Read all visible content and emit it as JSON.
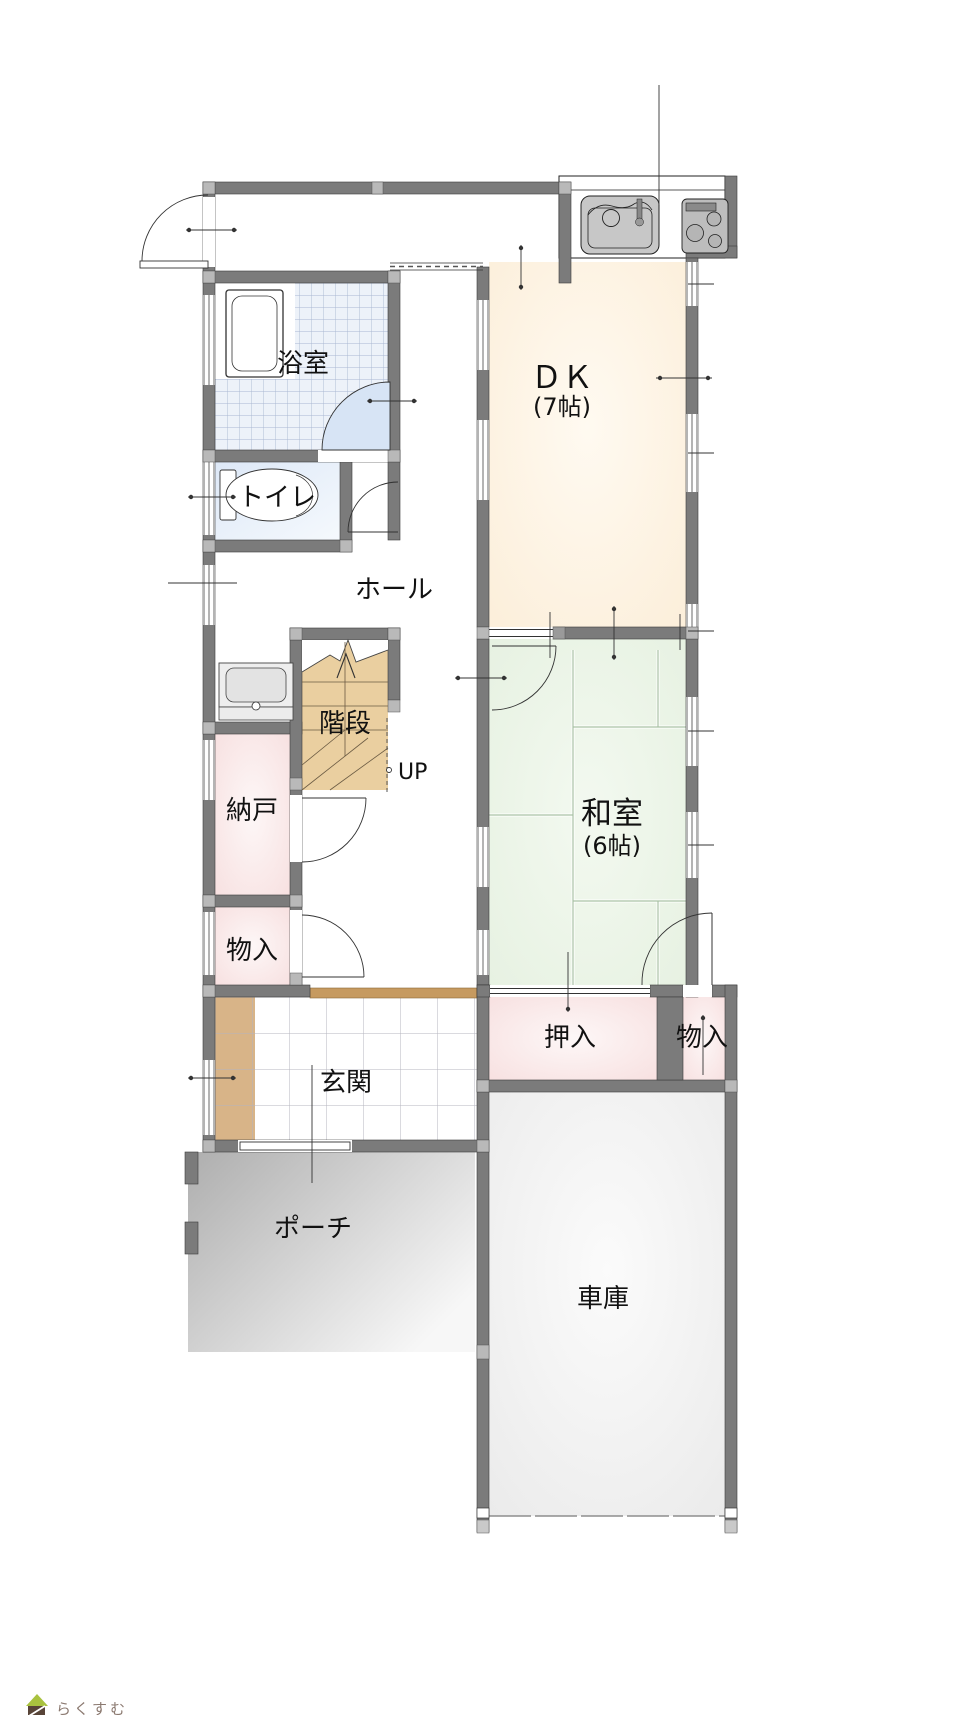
{
  "page": {
    "background": "#ffffff"
  },
  "floorplan": {
    "rooms": {
      "bathroom": {
        "label": "浴室"
      },
      "toilet": {
        "label": "トイレ"
      },
      "hall": {
        "label": "ホール"
      },
      "stairs": {
        "label": "階段",
        "direction_label": "UP"
      },
      "storage_room": {
        "label": "納戸"
      },
      "hall_closet": {
        "label": "物入"
      },
      "entrance": {
        "label": "玄関"
      },
      "porch": {
        "label": "ポーチ"
      },
      "dining_kitchen": {
        "label": "ＤＫ",
        "size": "(7帖)"
      },
      "japanese_room": {
        "label": "和室",
        "size": "(6帖)"
      },
      "futon_closet": {
        "label": "押入"
      },
      "garage_closet": {
        "label": "物入"
      },
      "garage": {
        "label": "車庫"
      }
    },
    "colors": {
      "wall": "#7b7b7b",
      "wall_joint": "#b9b9b9",
      "dk_floor": "#fcefdb",
      "tatami_floor": "#e6f1e1",
      "closet_floor": "#f7dfdf",
      "stairs_floor": "#eacfa0",
      "bath_tile": "#edf2f9",
      "toilet_floor": "#e3ecf8",
      "door_swing": "#d7e4f5",
      "entrance_step": "#d8b488",
      "agarikamachi": "#c69a60",
      "porch": "#bdbdbd",
      "garage_floor": "#efefef"
    }
  },
  "footer": {
    "brand": "らくすむ"
  }
}
